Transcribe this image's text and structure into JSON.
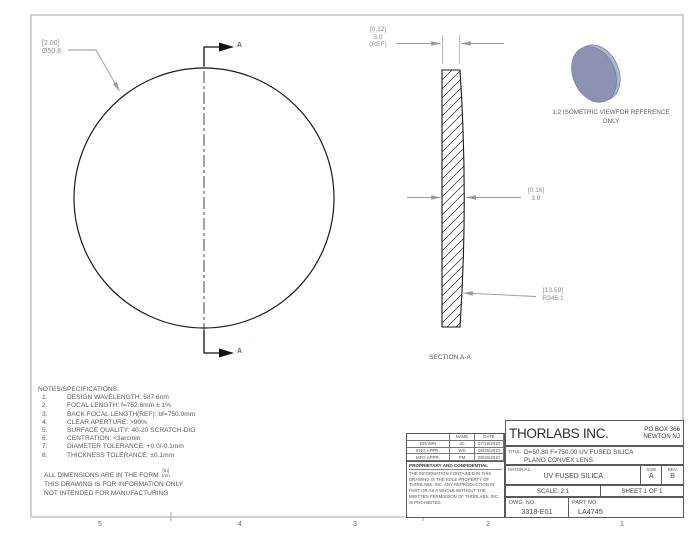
{
  "drawing": {
    "dims": {
      "diameter": {
        "line1": "[2.00]",
        "line2": "Ø50.8"
      },
      "edge_thickness": {
        "line1": "[0.12]",
        "line2": "3.0",
        "line3": "(REF)"
      },
      "center_thickness": {
        "line1": "[0.16]",
        "line2": "3.9"
      },
      "radius": {
        "line1": "[13.59]",
        "line2": "R345.1"
      }
    },
    "section_marker": "A",
    "section_view_label": "SECTION A-A",
    "isometric_caption": {
      "line1": "1:2 ISOMETRIC VIEWFOR REFERENCE",
      "line2": "ONLY"
    },
    "notes": {
      "title": "NOTES/SPECIFICATIONS:",
      "items": [
        {
          "num": "1.",
          "text": "DESIGN WAVELENGTH: 587.6nm"
        },
        {
          "num": "2.",
          "text": "FOCAL LENGTH: f=752.6mm ± 1%"
        },
        {
          "num": "3.",
          "text": "BACK FOCAL LENGTH(REF): bf=750.0mm"
        },
        {
          "num": "4.",
          "text": "CLEAR APERTURE: >90%"
        },
        {
          "num": "5.",
          "text": "SURFACE QUALITY: 40-20 SCRATCH-DIG"
        },
        {
          "num": "6.",
          "text": "CENTRATION: <3arcmin"
        },
        {
          "num": "7.",
          "text": "DIAMETER TOLERANCE: +0.0/-0.1mm"
        },
        {
          "num": "8.",
          "text": "THICKNESS TOLERANCE: ±0.1mm"
        }
      ]
    },
    "footer": {
      "dims_form_prefix": "ALL DIMENSIONS ARE IN THE FORM",
      "fraction_top": "[in]",
      "fraction_bottom": "mm",
      "info_only": "THIS DRAWING IS FOR INFORMATION ONLY",
      "not_mfg": "NOT INTENDED FOR MANUFACTURING"
    },
    "zone_labels": {
      "z5": "5",
      "z4": "4",
      "z3": "3",
      "z2": "2",
      "z1": "1"
    }
  },
  "title_block": {
    "company": "THORLABS INC.",
    "address_line1": "PO BOX 366",
    "address_line2": "NEWTON NJ",
    "approvals": {
      "headers": {
        "name": "NAME",
        "date": "DATE"
      },
      "rows": [
        {
          "role": "DRAWN",
          "name": "JC",
          "date": "07/19/2010"
        },
        {
          "role": "ENG APPR.",
          "name": "WD",
          "date": "08/25/2010"
        },
        {
          "role": "MFG APPR.",
          "name": "PM",
          "date": "08/26/2010"
        }
      ]
    },
    "proprietary": {
      "heading": "PROPRIETARY AND CONFIDENTIAL",
      "body": "THE INFORMATION CONTAINED IN THIS DRAWING IS THE SOLE PROPERTY OF THORLABS, INC.  ANY REPRODUCTION IN PART OR AS A WHOLE WITHOUT THE WRITTEN PERMISSION OF THORLABS, INC. IS PROHIBITED."
    },
    "title_label": "TITLE:",
    "title_line1": "D=50.80 F=750.00 UV FUSED SILICA",
    "title_line2": "PLANO CONVEX LENS",
    "material_label": "MATERIAL:",
    "material_value": "UV FUSED SILICA",
    "size_label": "SIZE",
    "size_value": "A",
    "rev_label": "REV.",
    "rev_value": "B",
    "scale": "SCALE: 2:1",
    "sheet": "SHEET 1 OF 1",
    "dwg_label": "DWG. NO.",
    "dwg_value": "3318-E01",
    "part_label": "PART NO.",
    "part_value": "LA4745"
  },
  "colors": {
    "section_marker_blue": "#4a69a8",
    "dim_text_gray": "#8f8f8f",
    "drawing_line": "#1a1a1a",
    "leader_gray": "#999999",
    "frame_gray": "#d2d2d2",
    "iso_lens_face": "#8b93b1",
    "iso_lens_rim": "#b0b6ca"
  }
}
